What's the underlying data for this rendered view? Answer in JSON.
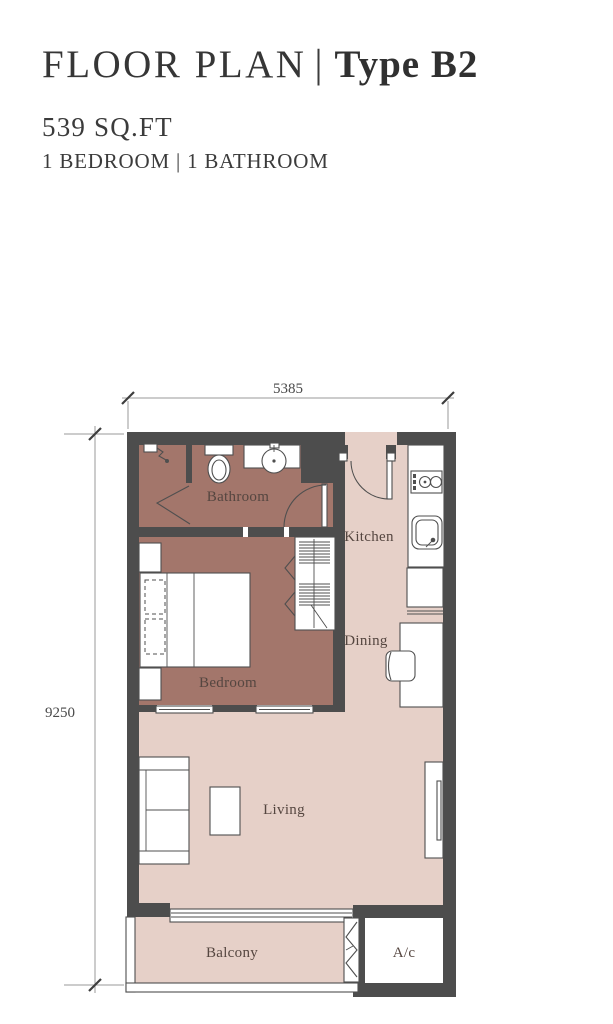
{
  "header": {
    "title_left": "FLOOR PLAN",
    "title_separator": "|",
    "title_right": "Type B2",
    "area": "539 SQ.FT",
    "configuration": "1 BEDROOM | 1 BATHROOM"
  },
  "floor_plan": {
    "dimensions": {
      "width": "5385",
      "height": "9250"
    },
    "rooms": {
      "bathroom": "Bathroom",
      "bedroom": "Bedroom",
      "kitchen": "Kitchen",
      "dining": "Dining",
      "living": "Living",
      "balcony": "Balcony",
      "ac": "A/c"
    },
    "colors": {
      "wall": "#4d4d4d",
      "private_floor": "#a3766b",
      "common_floor": "#e6d0c8",
      "label_text": "#554640"
    }
  }
}
